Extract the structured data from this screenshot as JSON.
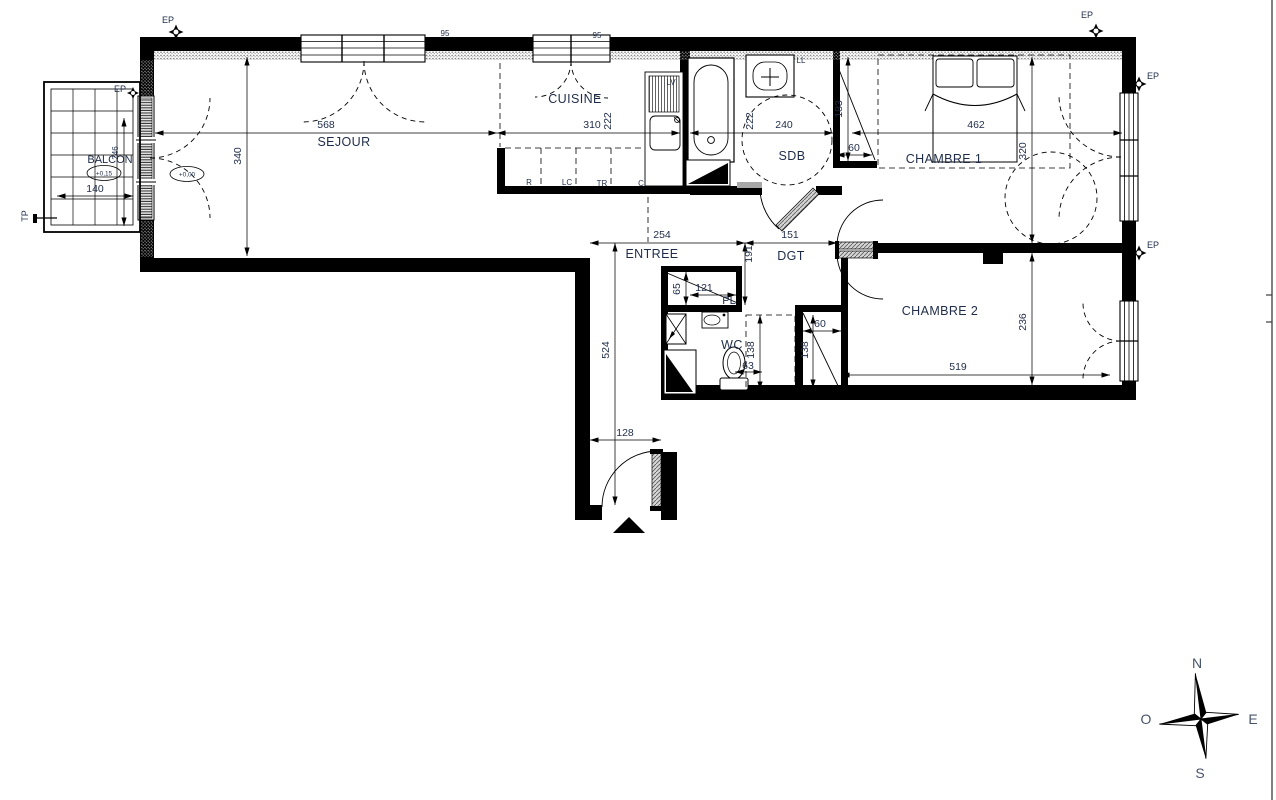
{
  "rooms": {
    "balcon": "BALCON",
    "sejour": "SEJOUR",
    "cuisine": "CUISINE",
    "sdb": "SDB",
    "chambre1": "CHAMBRE 1",
    "chambre2": "CHAMBRE 2",
    "entree": "ENTREE",
    "dgt": "DGT",
    "pl": "PL",
    "wc": "WC"
  },
  "levels": {
    "balcon": "+0,15",
    "sejour": "+0,00"
  },
  "dims": {
    "sejour_w": "568",
    "sejour_d": "340",
    "cuisine_w": "310",
    "cuisine_d": "222",
    "sdb_w": "240",
    "sdb_d": "222",
    "niche_d": "183",
    "niche_w": "60",
    "ch1_w": "462",
    "ch1_d": "320",
    "entree_w": "254",
    "dgt_w": "151",
    "dgt_d": "191",
    "hall_d": "524",
    "pl_d": "65",
    "pl_w": "121",
    "wc_d": "138",
    "wc_w": "63",
    "cl2_w": "60",
    "cl2_d": "138",
    "ch2_w": "519",
    "ch2_d": "236",
    "door_w": "128",
    "balcon_w": "140",
    "balcon_d": "246",
    "win1_h": "95",
    "win2_h": "95"
  },
  "appliances": {
    "r": "R",
    "lc": "LC",
    "tr": "TR",
    "c": "C",
    "lv": "LV",
    "ll": "LL"
  },
  "markers": {
    "ep": "EP",
    "tp": "TP"
  },
  "compass": {
    "n": "N",
    "s": "S",
    "e": "E",
    "o": "O"
  },
  "colors": {
    "ink": "#000000",
    "label": "#1f2c49",
    "compass_text": "#475569"
  }
}
